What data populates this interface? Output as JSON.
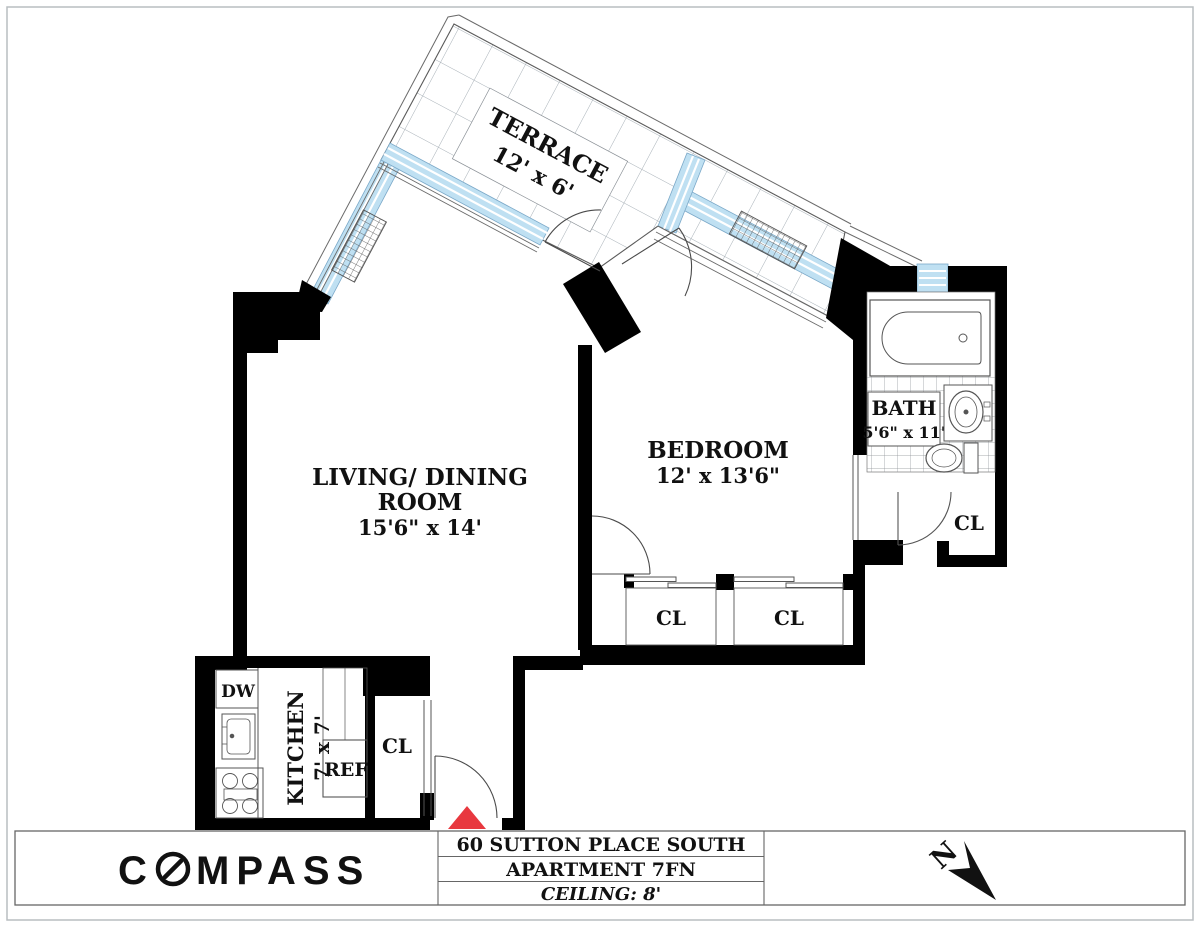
{
  "brand": {
    "logo_left": "C",
    "logo_right": "MPASS"
  },
  "title_block": {
    "address": "60 SUTTON PLACE SOUTH",
    "apartment": "APARTMENT 7FN",
    "ceiling": "CEILING: 8'"
  },
  "north_indicator": {
    "label": "N"
  },
  "rooms": {
    "terrace": {
      "name": "TERRACE",
      "dims": "12' x 6'"
    },
    "living_dining": {
      "name_line1": "LIVING/ DINING",
      "name_line2": "ROOM",
      "dims": "15'6\" x 14'"
    },
    "bedroom": {
      "name": "BEDROOM",
      "dims": "12' x 13'6\""
    },
    "bath": {
      "name": "BATH",
      "dims": "5'6\" x 11'"
    },
    "kitchen": {
      "name": "KITCHEN",
      "dims": "7' x 7'"
    }
  },
  "closets": {
    "bedroom_closet_1": "CL",
    "bedroom_closet_2": "CL",
    "bath_closet": "CL",
    "entry_closet": "CL"
  },
  "appliances": {
    "dishwasher": "DW",
    "refrigerator": "REF"
  },
  "colors": {
    "wall": "#000000",
    "window_glass": "#bfe0f2",
    "entry_marker": "#e8383f",
    "line": "#4a4a4a"
  }
}
